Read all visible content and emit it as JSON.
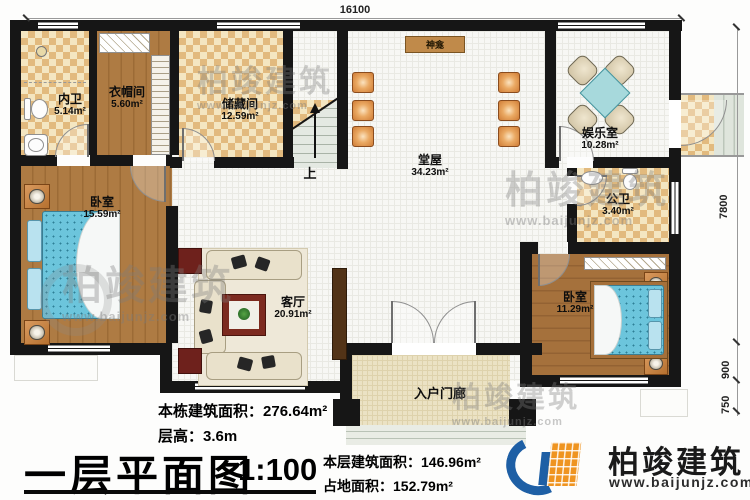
{
  "plan": {
    "title": "一层平面图",
    "scale": "1:100"
  },
  "dimensions": {
    "top_width": "16100",
    "right_depth": "7800",
    "right_bedroom": "900",
    "right_porch": "750"
  },
  "rooms": {
    "inner_bath": {
      "name": "内卫",
      "area": "5.14m²"
    },
    "cloakroom": {
      "name": "衣帽间",
      "area": "5.60m²"
    },
    "storage": {
      "name": "储藏间",
      "area": "12.59m²"
    },
    "main_hall": {
      "name": "堂屋",
      "area": "34.23m²"
    },
    "entertainment": {
      "name": "娱乐室",
      "area": "10.28m²"
    },
    "public_bath": {
      "name": "公卫",
      "area": "3.40m²"
    },
    "bedroom_left": {
      "name": "卧室",
      "area": "15.59m²"
    },
    "living_room": {
      "name": "客厅",
      "area": "20.91m²"
    },
    "bedroom_right": {
      "name": "卧室",
      "area": "11.29m²"
    },
    "entry_porch": {
      "name": "入户门廊"
    }
  },
  "features": {
    "shrine": "神龛",
    "stairs_up": "上"
  },
  "stats": {
    "total_area_label": "本栋建筑面积：",
    "total_area_value": "276.64m²",
    "floor_height_label": "层高：",
    "floor_height_value": "3.6m",
    "floor_area_label": "本层建筑面积：",
    "floor_area_value": "146.96m²",
    "footprint_label": "占地面积：",
    "footprint_value": "152.79m²"
  },
  "brand": {
    "name": "柏竣建筑",
    "url": "www.baijunjz.com"
  },
  "watermark": {
    "name": "柏竣建筑",
    "url": "www.baijunjz.com"
  },
  "colors": {
    "wall": "#161616",
    "checker_dark": "#e2ba7e",
    "checker_light": "#f4e6c1",
    "wood": "#aa763f",
    "tile": "#f7f7f4",
    "bed": "#6cc5dc",
    "brand_blue": "#1e5fa5",
    "brand_orange": "#ef9420"
  }
}
